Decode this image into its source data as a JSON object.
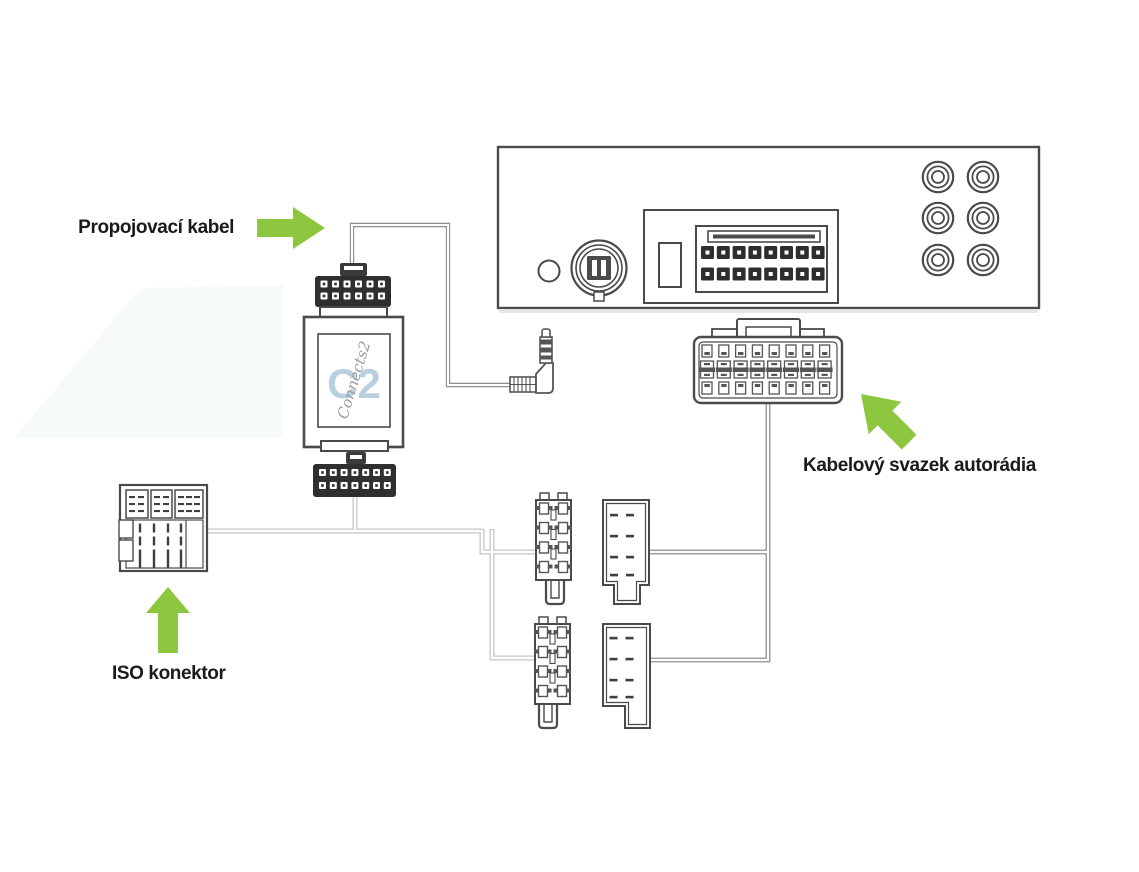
{
  "labels": {
    "cable": "Propojovací kabel",
    "iso": "ISO konektor",
    "harness": "Kabelový svazek autorádia"
  },
  "adapter": {
    "logo_mark": "C2",
    "logo_script": "Connects2"
  },
  "colors": {
    "accent_green": "#8dc63f",
    "line": "#4a4a4a",
    "dark_fill": "#2f2f2f",
    "wire_light": "#c6c6c6",
    "wire_dark": "#8f8f8f",
    "logo_blue": "#b9cfde",
    "label_text": "#1a1a1a"
  }
}
